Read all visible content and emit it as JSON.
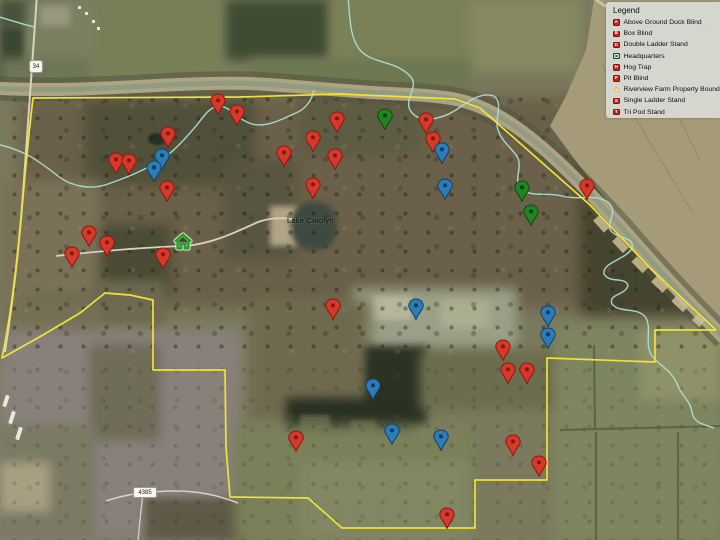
{
  "app": {
    "description": "Satellite hunting-property map with placemarks"
  },
  "legend": {
    "title": "Legend",
    "items": [
      {
        "label": "Above Ground Duck Blind",
        "icon": "red-square",
        "glyph": "A"
      },
      {
        "label": "Box Blind",
        "icon": "red-square",
        "glyph": "B"
      },
      {
        "label": "Double Ladder Stand",
        "icon": "red-square",
        "glyph": "D"
      },
      {
        "label": "Headquarters",
        "icon": "green-square",
        "glyph": ""
      },
      {
        "label": "Hog Trap",
        "icon": "red-square",
        "glyph": "H"
      },
      {
        "label": "Pit Blind",
        "icon": "red-square",
        "glyph": "P"
      },
      {
        "label": "Riverview Farm Property Boundary",
        "icon": "yellow-polygon",
        "glyph": ""
      },
      {
        "label": "Single Ladder Stand",
        "icon": "red-square",
        "glyph": "S"
      },
      {
        "label": "Tri Pod Stand",
        "icon": "red-square",
        "glyph": "T"
      }
    ]
  },
  "map": {
    "labels": {
      "lake": "Lake Carolyn",
      "highway_shield": "34",
      "road_shield": "4385"
    },
    "colors": {
      "boundary": "#f0e23a",
      "creek": "#aadfd2",
      "pin_red": {
        "fill": "#d6392a",
        "stroke": "#87190f",
        "dot": "#7d1a12"
      },
      "pin_blue": {
        "fill": "#2b7cb9",
        "stroke": "#143f63",
        "dot": "#123a58"
      },
      "pin_green": {
        "fill": "#218421",
        "stroke": "#0c4a0c",
        "dot": "#0a3d0a"
      },
      "hq_green": "#1fa41f"
    },
    "hq": {
      "x": 183,
      "y": 242
    },
    "pins": [
      {
        "x": 218,
        "y": 103,
        "color": "red"
      },
      {
        "x": 237,
        "y": 114,
        "color": "red"
      },
      {
        "x": 168,
        "y": 136,
        "color": "red"
      },
      {
        "x": 116,
        "y": 162,
        "color": "red"
      },
      {
        "x": 129,
        "y": 163,
        "color": "red"
      },
      {
        "x": 167,
        "y": 190,
        "color": "red"
      },
      {
        "x": 89,
        "y": 235,
        "color": "red"
      },
      {
        "x": 107,
        "y": 245,
        "color": "red"
      },
      {
        "x": 72,
        "y": 256,
        "color": "red"
      },
      {
        "x": 163,
        "y": 257,
        "color": "red"
      },
      {
        "x": 284,
        "y": 155,
        "color": "red"
      },
      {
        "x": 313,
        "y": 140,
        "color": "red"
      },
      {
        "x": 335,
        "y": 158,
        "color": "red"
      },
      {
        "x": 313,
        "y": 187,
        "color": "red"
      },
      {
        "x": 337,
        "y": 121,
        "color": "red"
      },
      {
        "x": 426,
        "y": 122,
        "color": "red"
      },
      {
        "x": 433,
        "y": 141,
        "color": "red"
      },
      {
        "x": 587,
        "y": 188,
        "color": "red"
      },
      {
        "x": 333,
        "y": 308,
        "color": "red"
      },
      {
        "x": 503,
        "y": 349,
        "color": "red"
      },
      {
        "x": 508,
        "y": 372,
        "color": "red"
      },
      {
        "x": 527,
        "y": 372,
        "color": "red"
      },
      {
        "x": 296,
        "y": 440,
        "color": "red"
      },
      {
        "x": 513,
        "y": 444,
        "color": "red"
      },
      {
        "x": 539,
        "y": 465,
        "color": "red"
      },
      {
        "x": 447,
        "y": 517,
        "color": "red"
      },
      {
        "x": 162,
        "y": 158,
        "color": "blue"
      },
      {
        "x": 154,
        "y": 170,
        "color": "blue"
      },
      {
        "x": 442,
        "y": 152,
        "color": "blue"
      },
      {
        "x": 445,
        "y": 188,
        "color": "blue"
      },
      {
        "x": 416,
        "y": 308,
        "color": "blue"
      },
      {
        "x": 373,
        "y": 388,
        "color": "blue"
      },
      {
        "x": 548,
        "y": 315,
        "color": "blue"
      },
      {
        "x": 548,
        "y": 337,
        "color": "blue"
      },
      {
        "x": 392,
        "y": 433,
        "color": "blue"
      },
      {
        "x": 441,
        "y": 439,
        "color": "blue"
      },
      {
        "x": 385,
        "y": 118,
        "color": "green"
      },
      {
        "x": 522,
        "y": 190,
        "color": "green"
      },
      {
        "x": 531,
        "y": 214,
        "color": "green"
      }
    ]
  }
}
